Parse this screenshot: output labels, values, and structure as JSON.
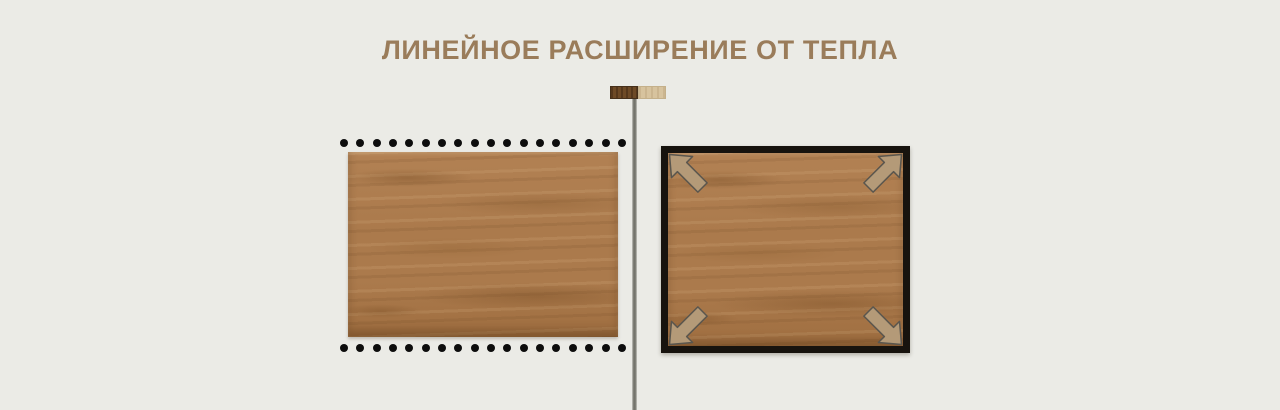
{
  "title": {
    "text": "ЛИНЕЙНОЕ РАСШИРЕНИЕ ОТ ТЕПЛА"
  },
  "colors": {
    "background": "#ebebe6",
    "title": "#9a7c5a",
    "dot": "#0d0d0d",
    "divider_light": "#c6c6c0",
    "divider_dark": "#74746c",
    "frame": "#17130e",
    "arrow_fill": "#b49a78",
    "arrow_outline": "#5a564e",
    "wood_base": "#ab7a4c",
    "wood_light": "#b28153",
    "wood_dark": "#9f6e40",
    "swatch_dark": "#6e4a26",
    "swatch_dark_border": "#46301a",
    "swatch_light": "#d7c39e",
    "swatch_light_border": "#c4b08a"
  },
  "legend_icon": {
    "left": "dark-wood-swatch",
    "right": "light-wood-swatch"
  },
  "left_figure": {
    "dots_per_row": 18,
    "dot_rows": [
      "top",
      "bottom"
    ]
  },
  "right_figure": {
    "arrows": [
      "top-left",
      "top-right",
      "bottom-left",
      "bottom-right"
    ]
  }
}
